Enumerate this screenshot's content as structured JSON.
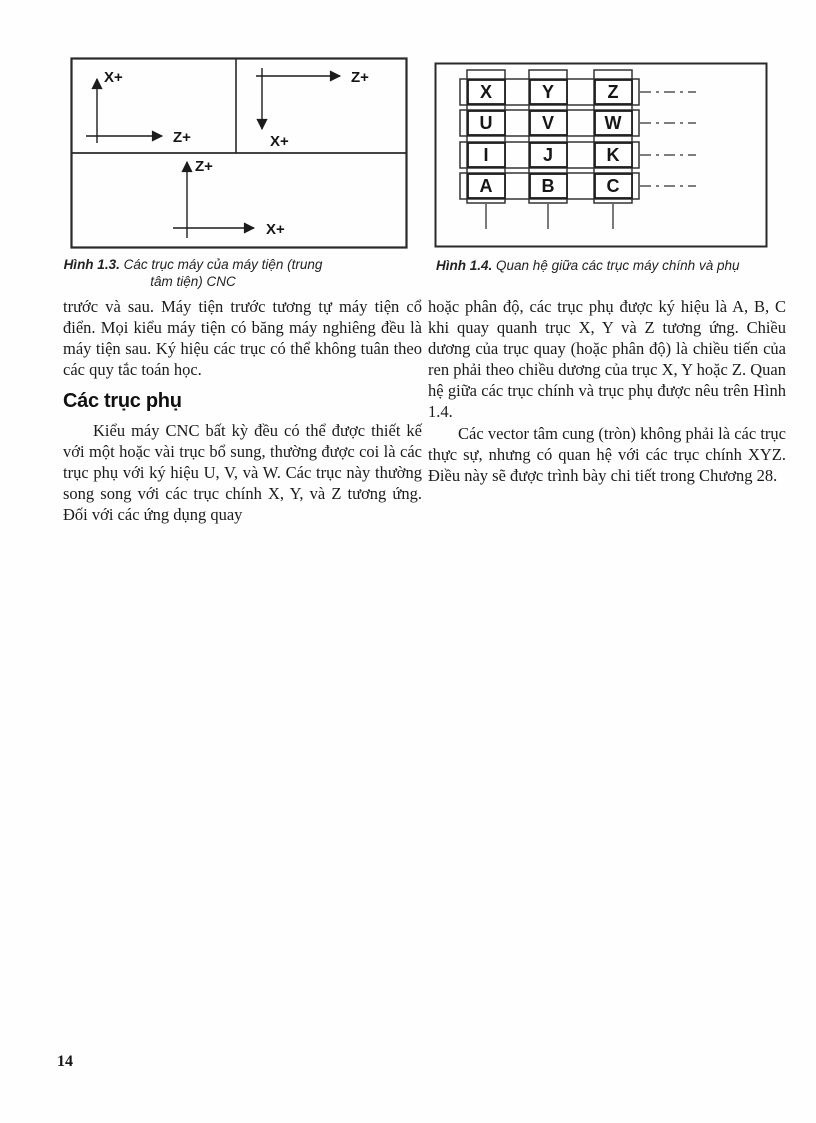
{
  "page": {
    "number": "14"
  },
  "figures": [
    {
      "caption_label": "Hình 1.3.",
      "caption_text": "Các trục máy của máy tiện (trung tâm tiện) CNC",
      "labels": {
        "tl_x": "X+",
        "tl_z": "Z+",
        "tr_z": "Z+",
        "tr_x": "X+",
        "b_z": "Z+",
        "b_x": "X+"
      }
    },
    {
      "caption_label": "Hình 1.4.",
      "caption_text": "Quan hệ giữa các trục máy chính và phụ",
      "grid": [
        [
          "X",
          "Y",
          "Z"
        ],
        [
          "U",
          "V",
          "W"
        ],
        [
          "I",
          "J",
          "K"
        ],
        [
          "A",
          "B",
          "C"
        ]
      ]
    }
  ],
  "columns": {
    "left": {
      "para1": "trước và sau. Máy tiện trước tương tự máy tiện cổ điển. Mọi kiểu máy tiện có băng máy nghiêng đều là máy tiện sau. Ký hiệu các trục có thể không tuân theo các quy tắc toán học.",
      "heading": "Các trục phụ",
      "para2": "Kiểu máy CNC bất kỳ đều có thể được thiết kế với một hoặc vài trục bổ sung, thường được coi là các trục phụ với ký hiệu U, V, và W. Các trục này thường song song với các trục chính X, Y, và Z tương ứng. Đối với các ứng dụng quay"
    },
    "right": {
      "para1": "hoặc phân độ, các trục phụ được ký hiệu là A, B, C khi quay quanh trục X, Y và Z tương ứng. Chiều dương của trục quay (hoặc phân độ) là chiều tiến của ren phải theo chiều dương của trục X, Y hoặc Z. Quan hệ giữa các trục chính và trục phụ được nêu trên Hình 1.4.",
      "para2": "Các vector tâm cung (tròn) không phải là các trục thực sự, nhưng có quan hệ với các trục chính XYZ. Điều này sẽ được trình bày chi tiết trong Chương 28."
    }
  }
}
